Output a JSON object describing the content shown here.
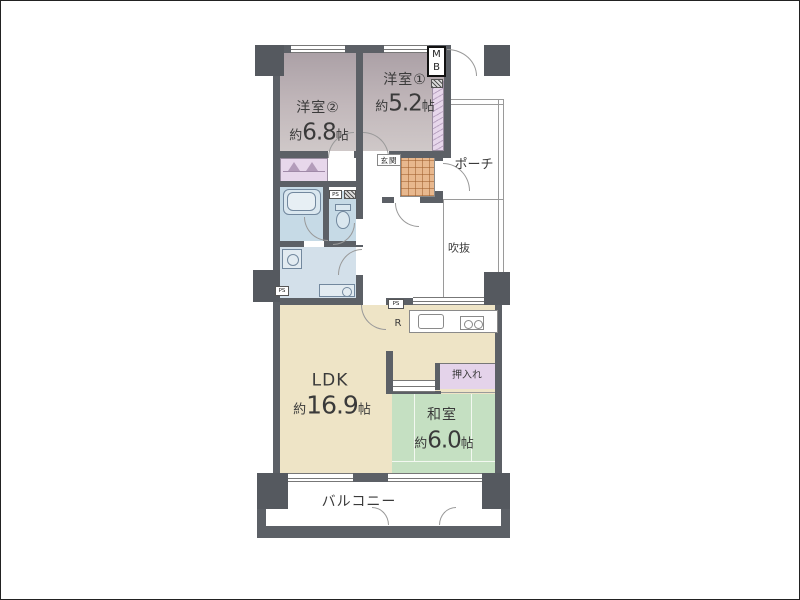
{
  "plan": {
    "rooms": {
      "bedroom2": {
        "name": "洋室②",
        "approx": "約",
        "value": "6.8",
        "unit": "帖"
      },
      "bedroom1": {
        "name": "洋室①",
        "approx": "約",
        "value": "5.2",
        "unit": "帖"
      },
      "ldk": {
        "name": "LDK",
        "approx": "約",
        "value": "16.9",
        "unit": "帖"
      },
      "japanese_room": {
        "name": "和室",
        "approx": "約",
        "value": "6.0",
        "unit": "帖"
      },
      "closet": {
        "name": "押入れ"
      },
      "entrance": {
        "name": "玄関"
      },
      "porch": {
        "name": "ポーチ"
      },
      "void": {
        "name": "吹抜"
      },
      "balcony": {
        "name": "バルコニー"
      }
    },
    "annotations": {
      "meter_box": "MB",
      "refrigerator": "R",
      "pipe_space": "PS"
    },
    "colors": {
      "wall": "#5c6066",
      "bedroom_floor": "#c0b6b9",
      "closet_floor": "#e7d7eb",
      "bathroom_floor": "#c6dae6",
      "washroom_floor": "#d3e0ea",
      "ldk_floor": "#eee4c6",
      "tatami_floor": "#c5e0c2",
      "oshiire_floor": "#e4d3ea",
      "entrance_tile": "#e8b88e"
    }
  }
}
